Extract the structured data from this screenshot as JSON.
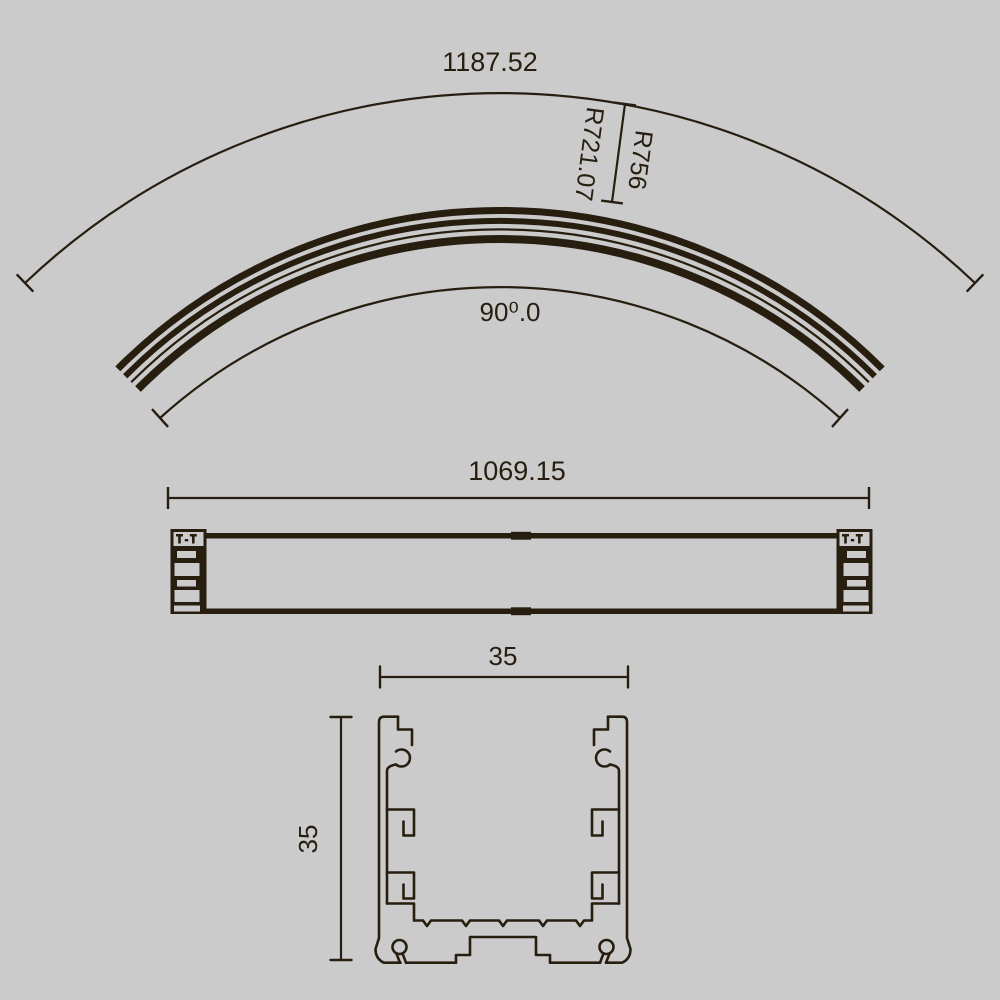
{
  "colors": {
    "background": "#cbcbcb",
    "ink": "#271e10"
  },
  "arc_view": {
    "arc_length": "1187.52",
    "radius_outer": "R756",
    "radius_inner": "R721.07",
    "angle": "90⁰.0"
  },
  "side_view": {
    "length": "1069.15"
  },
  "section_view": {
    "width": "35",
    "height": "35"
  }
}
